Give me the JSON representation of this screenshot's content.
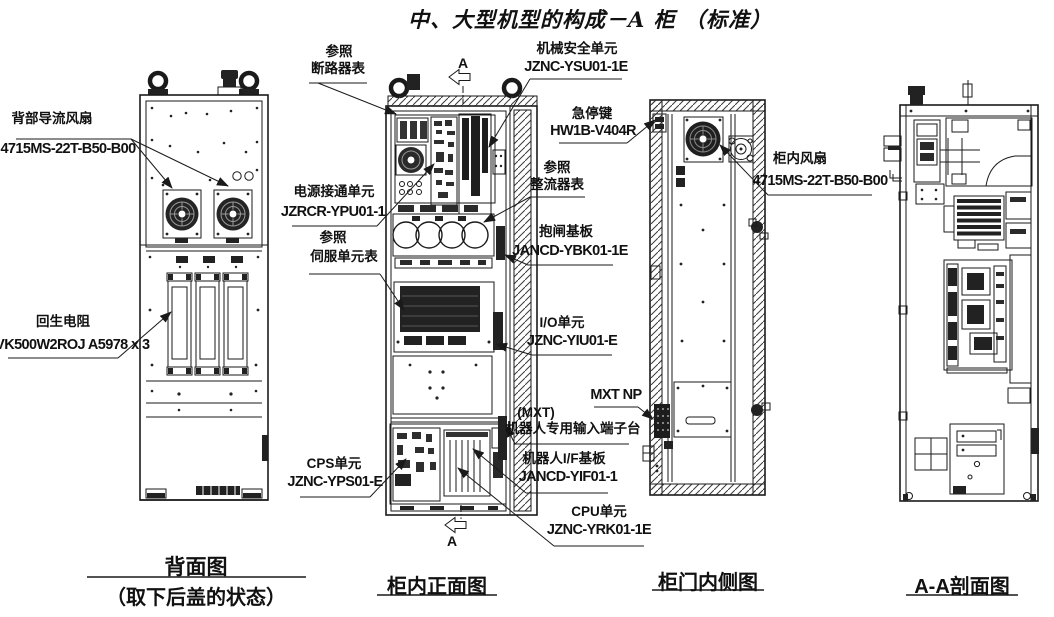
{
  "title": "中、大型机型的构成－A 柜 （标准）",
  "section_marker": {
    "top": "A",
    "bottom": "A"
  },
  "callouts": {
    "rear_duct_fan": {
      "line1": "背部导流风扇",
      "line2": "4715MS-22T-B50-B00"
    },
    "regen_resistor": {
      "line1": "回生电阻",
      "line2": "SMVK500W2ROJ A5978 x 3"
    },
    "breaker_ref": {
      "line1": "参照",
      "line2": "断路器表"
    },
    "machine_safety_unit": {
      "line1": "机械安全单元",
      "line2": "JZNC-YSU01-1E"
    },
    "estop_key": {
      "line1": "急停键",
      "line2": "HW1B-V404R"
    },
    "power_on_unit": {
      "line1": "电源接通单元",
      "line2": "JZRCR-YPU01-1"
    },
    "servo_unit_ref": {
      "line1": "参照",
      "line2": "伺服单元表"
    },
    "rectifier_ref": {
      "line1": "参照",
      "line2": "整流器表"
    },
    "brake_board": {
      "line1": "抱闸基板",
      "line2": "JANCD-YBK01-1E"
    },
    "io_unit": {
      "line1": "I/O单元",
      "line2": "JZNC-YIU01-E"
    },
    "cabinet_fan": {
      "line1": "柜内风扇",
      "line2": "4715MS-22T-B50-B00"
    },
    "mxt_np": {
      "line1": "MXT NP"
    },
    "mxt_terminal": {
      "line1": "(MXT)",
      "line2": "机器人专用输入端子台"
    },
    "robot_if_board": {
      "line1": "机器人I/F基板",
      "line2": "JANCD-YIF01-1"
    },
    "cps_unit": {
      "line1": "CPS单元",
      "line2": "JZNC-YPS01-E"
    },
    "cpu_unit": {
      "line1": "CPU单元",
      "line2": "JZNC-YRK01-1E"
    }
  },
  "captions": {
    "back_view": {
      "line1": "背面图",
      "line2": "（取下后盖的状态）"
    },
    "front_view": {
      "line1": "柜内正面图"
    },
    "door_view": {
      "line1": "柜门内侧图"
    },
    "section_view": {
      "line1": "A-A剖面图"
    }
  },
  "colors": {
    "ink": "#1a1a1a",
    "background": "#ffffff"
  }
}
